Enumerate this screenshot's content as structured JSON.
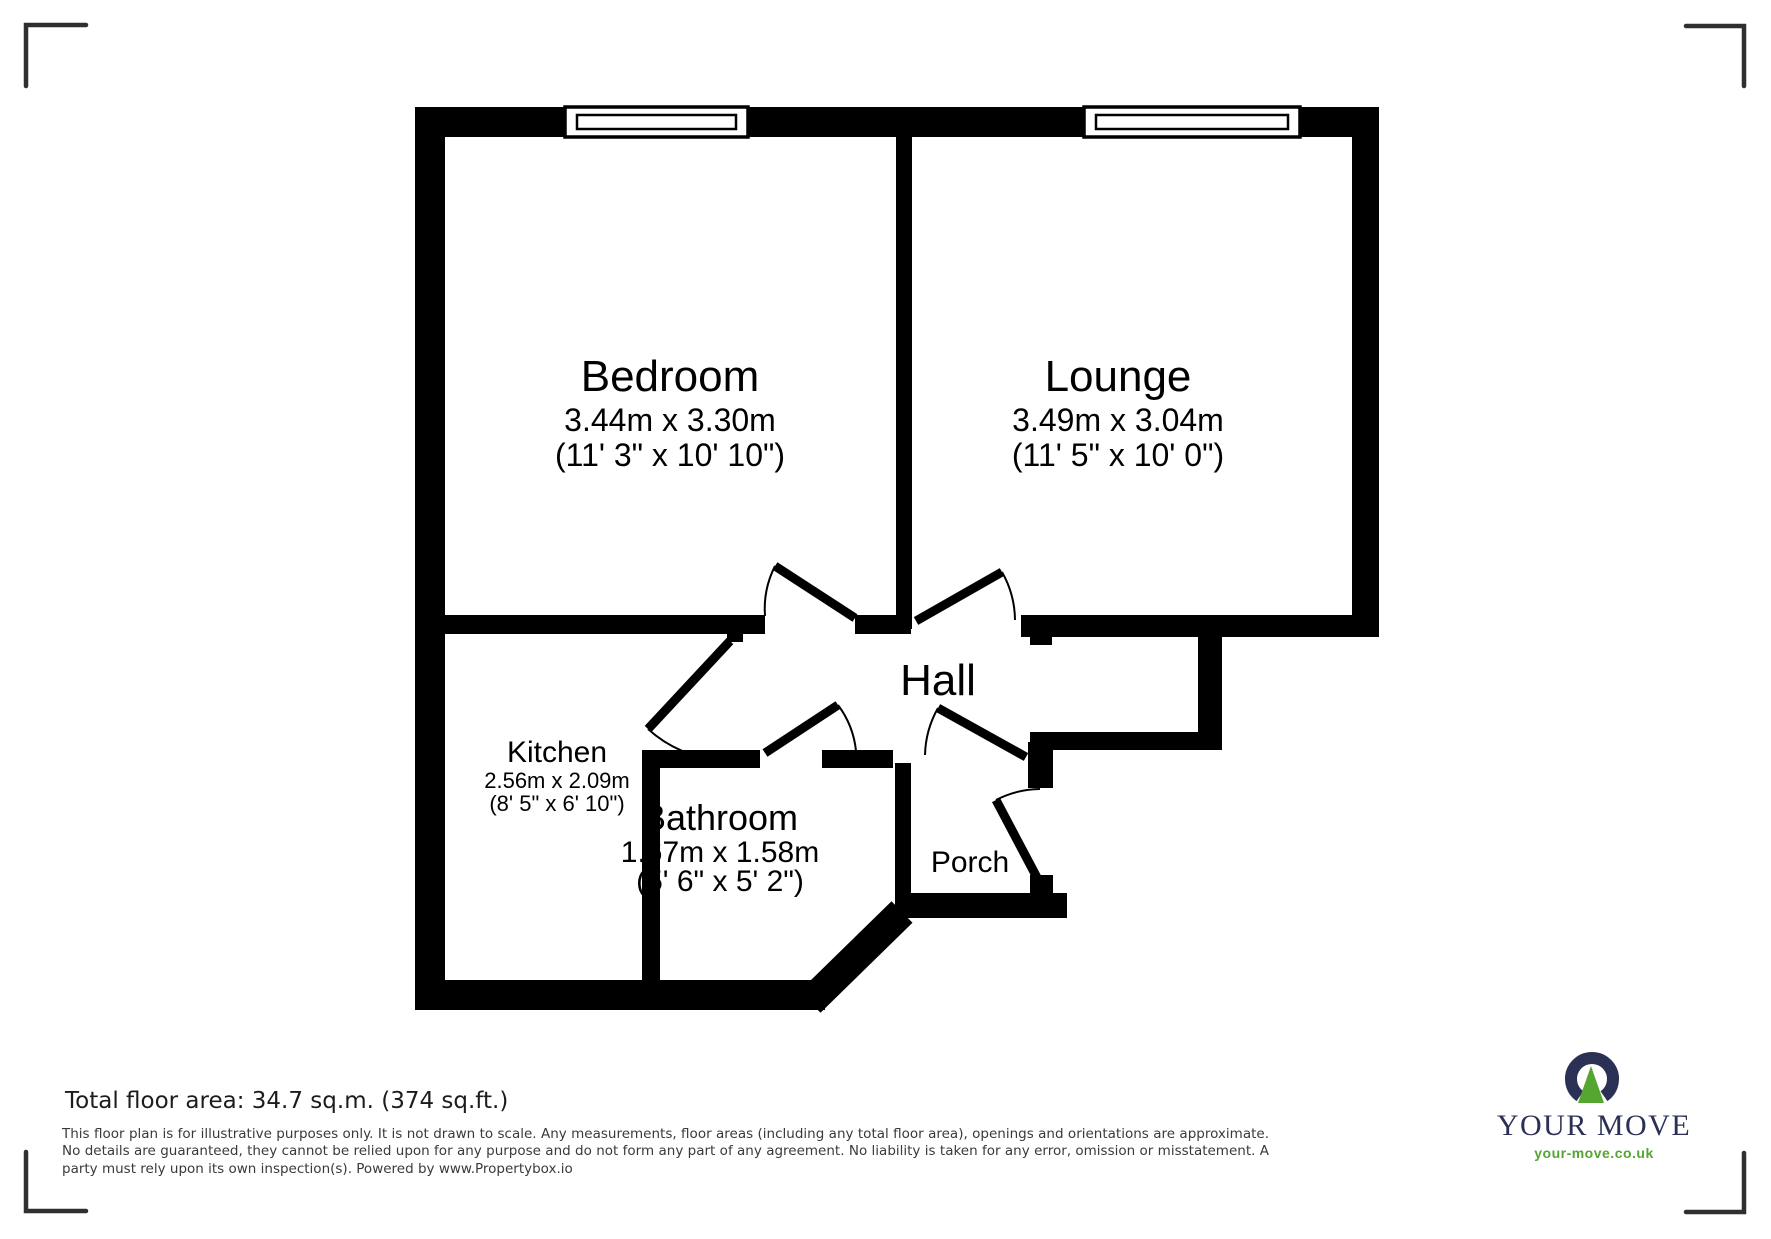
{
  "plan": {
    "rooms": [
      {
        "name": "Bedroom",
        "metric": "3.44m x 3.30m",
        "imperial": "(11' 3\" x 10' 10\")"
      },
      {
        "name": "Lounge",
        "metric": "3.49m x 3.04m",
        "imperial": "(11' 5\" x 10' 0\")"
      },
      {
        "name": "Hall"
      },
      {
        "name": "Kitchen",
        "metric": "2.56m x 2.09m",
        "imperial": "(8' 5\" x 6' 10\")"
      },
      {
        "name": "Bathroom",
        "metric": "1.67m x 1.58m",
        "imperial": "(5' 6\" x 5' 2\")"
      },
      {
        "name": "Porch"
      }
    ],
    "wall_color": "#000000"
  },
  "footer": {
    "total_area": "Total floor area: 34.7 sq.m. (374 sq.ft.)",
    "disclaimer": "This floor plan is for illustrative purposes only. It is not drawn to scale. Any measurements, floor areas (including any total floor area), openings and orientations are approximate. No details are guaranteed, they cannot be relied upon for any purpose and do not form any part of any agreement. No liability is taken for any error, omission or misstatement. A party must rely upon its own inspection(s). Powered by www.Propertybox.io"
  },
  "logo": {
    "name": "YOUR MOVE",
    "url": "your-move.co.uk",
    "navy": "#2b3154",
    "green": "#55a630"
  }
}
